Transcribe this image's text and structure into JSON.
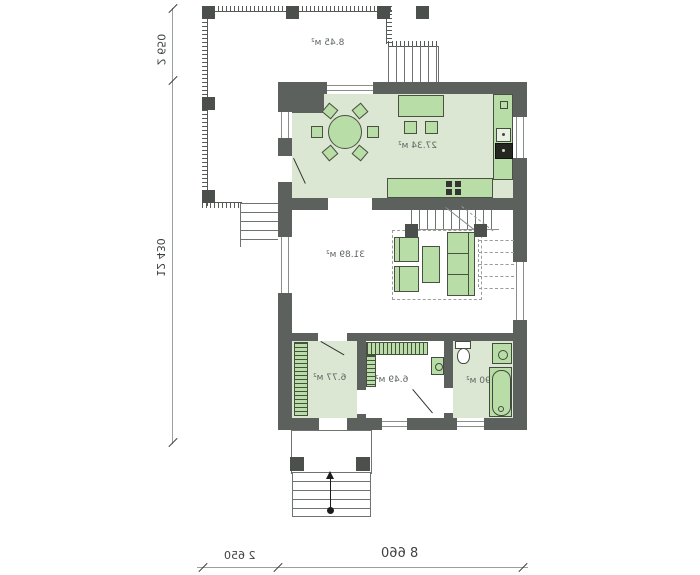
{
  "plan": {
    "areas": {
      "terrace": "8.45 м²",
      "kitchen": "27.34 м²",
      "living": "31.89 м²",
      "vestibule": "6.77 м²",
      "hall": "6.49 м²",
      "bathroom": "7.90 м²"
    },
    "dimensions": {
      "terrace_depth": "2 650",
      "house_length": "12 430",
      "terrace_width": "2 650",
      "house_width": "8 660"
    },
    "colors": {
      "wall": "#5d615d",
      "floor": "#dce7d3",
      "furniture": "#b9dda7",
      "line": "#6f736f"
    }
  }
}
